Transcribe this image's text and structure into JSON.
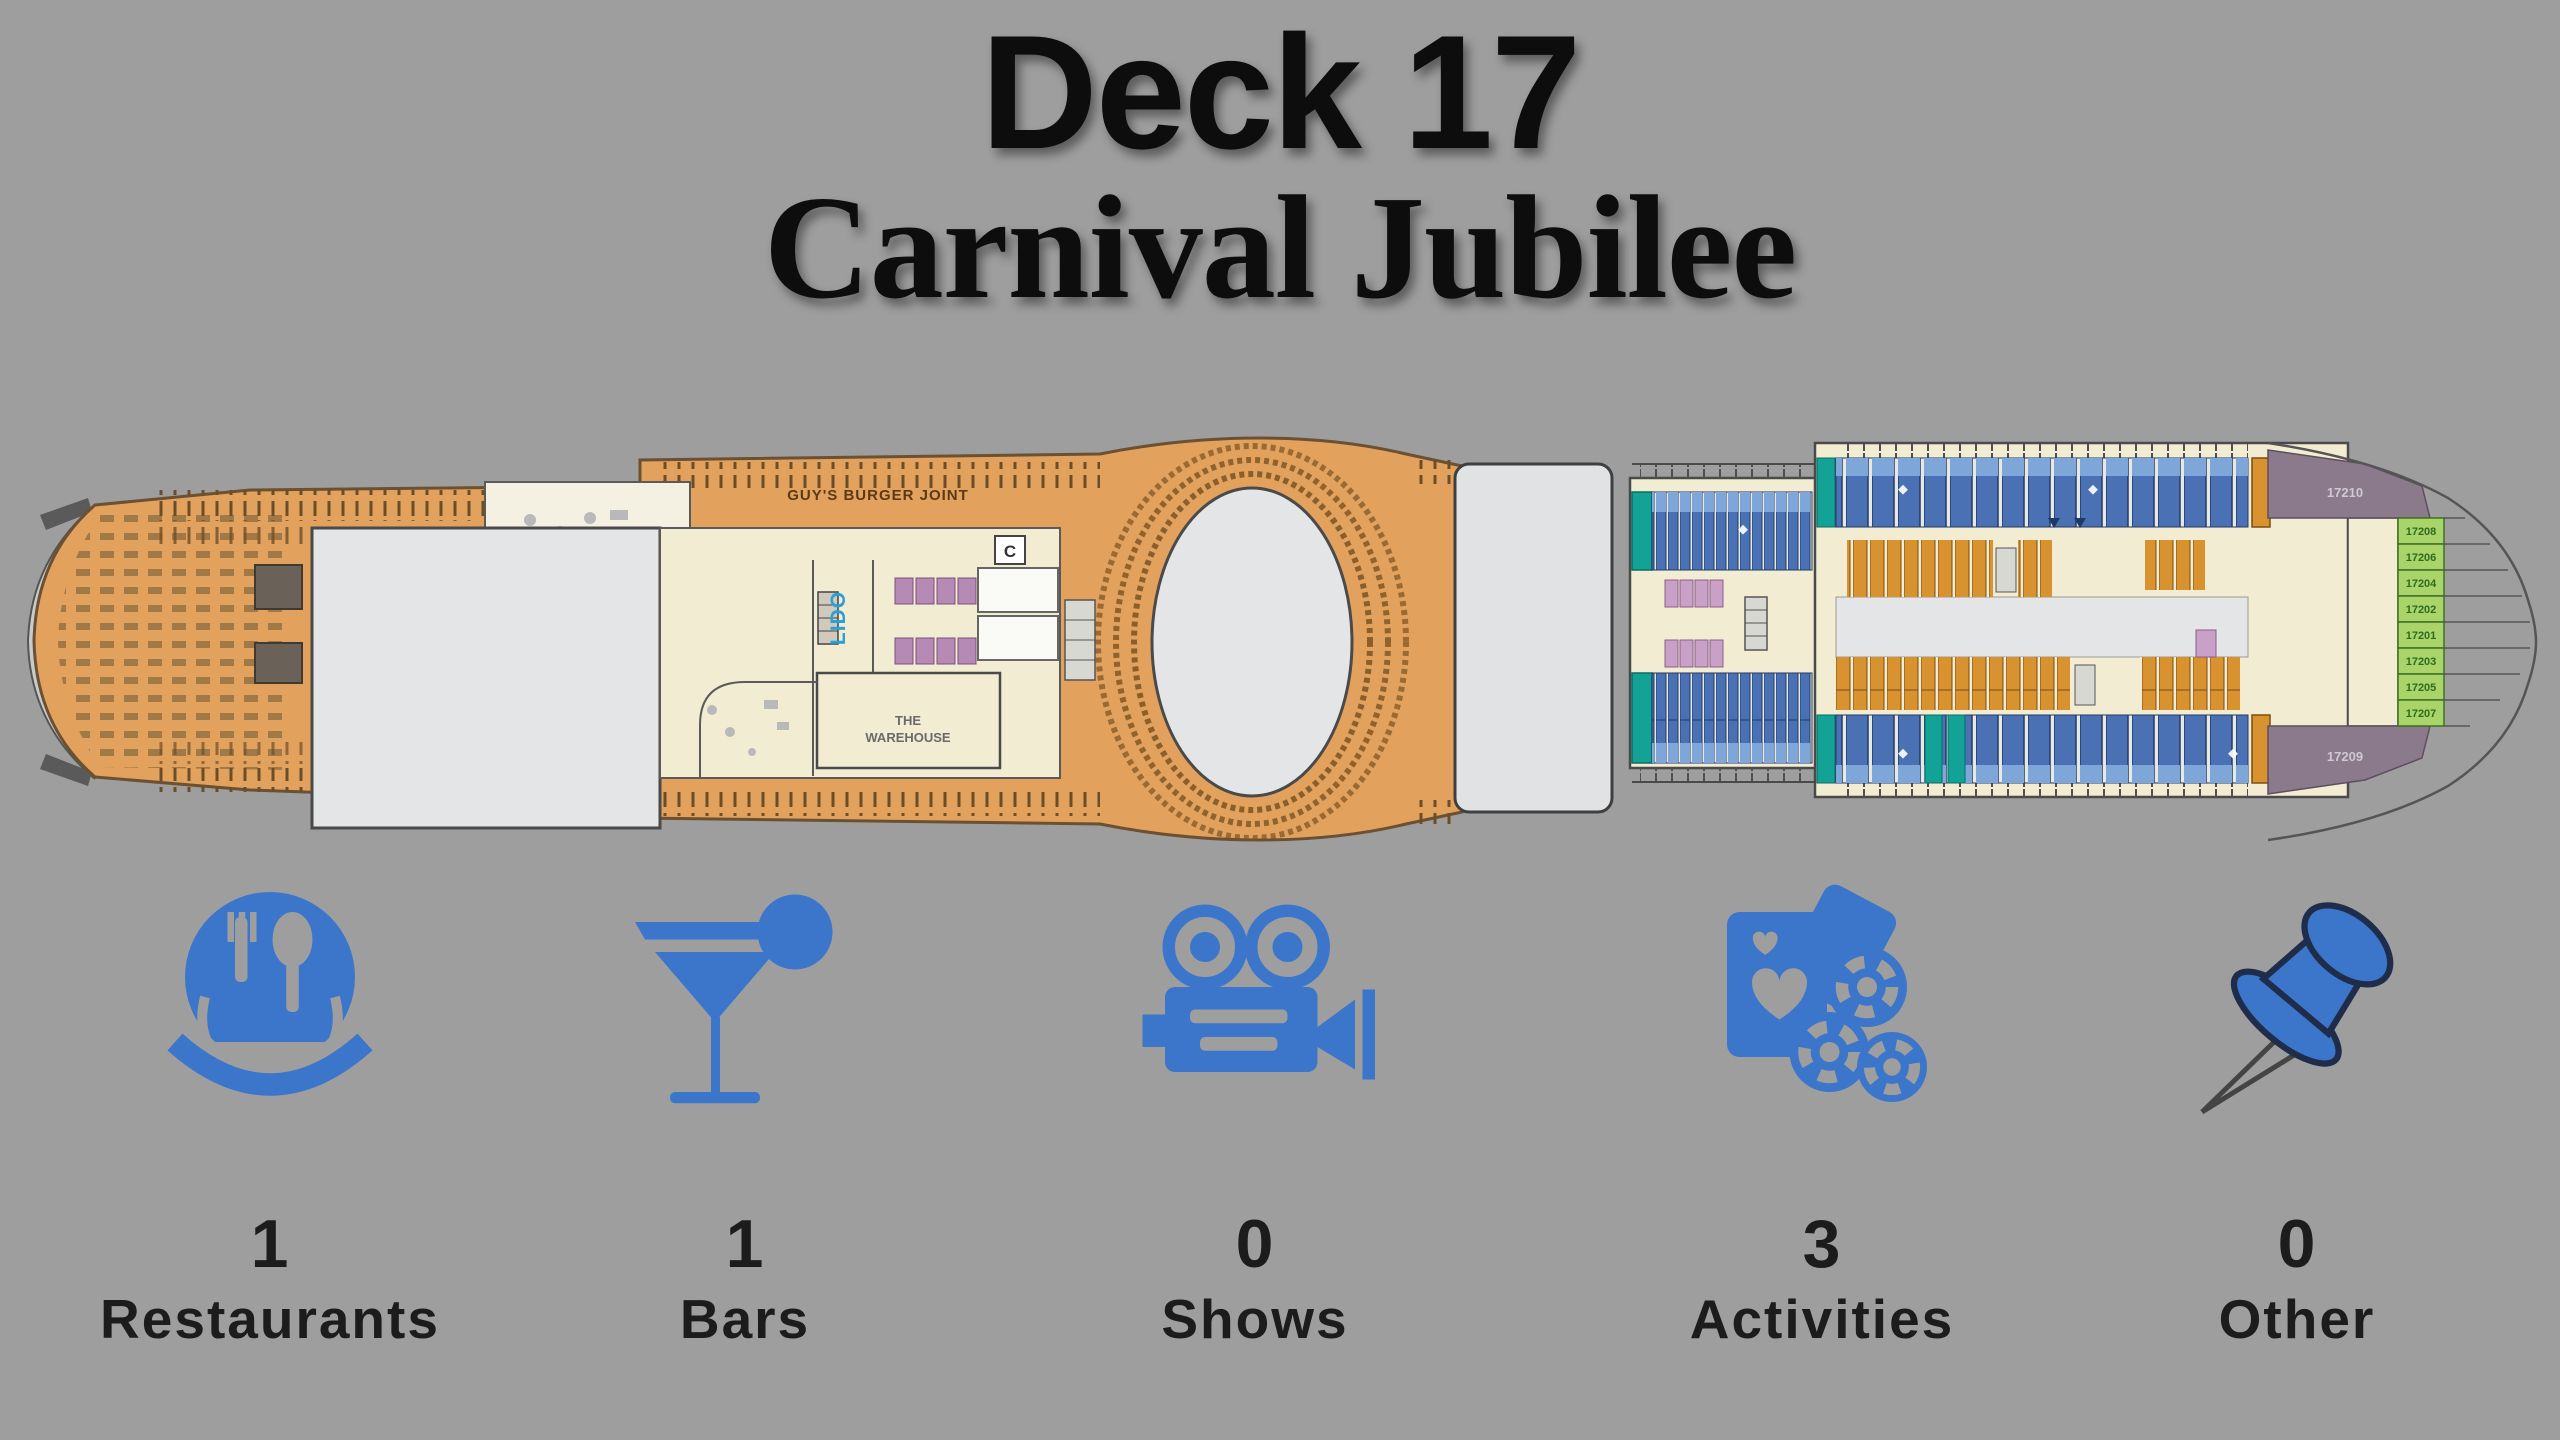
{
  "header": {
    "deck_title": "Deck 17",
    "ship_name": "Carnival Jubilee"
  },
  "deck_plan": {
    "venues": {
      "burger_joint": "GUY'S BURGER JOINT",
      "lido": "LIDO",
      "warehouse_line1": "THE",
      "warehouse_line2": "WAREHOUSE",
      "elevator": "C"
    },
    "cabin_numbers": {
      "bow_top_corner": "17210",
      "bow_bottom_corner": "17209",
      "green": [
        "17208",
        "17206",
        "17204",
        "17202",
        "17201",
        "17203",
        "17205",
        "17207"
      ]
    }
  },
  "stats": [
    {
      "id": "restaurants",
      "icon": "restaurant-icon",
      "count": "1",
      "label": "Restaurants"
    },
    {
      "id": "bars",
      "icon": "cocktail-icon",
      "count": "1",
      "label": "Bars"
    },
    {
      "id": "shows",
      "icon": "movie-camera-icon",
      "count": "0",
      "label": "Shows"
    },
    {
      "id": "activities",
      "icon": "casino-icon",
      "count": "3",
      "label": "Activities"
    },
    {
      "id": "other",
      "icon": "push-pin-icon",
      "count": "0",
      "label": "Other"
    }
  ],
  "colors": {
    "background": "#9e9e9e",
    "icon_blue": "#3b76cb",
    "deck_orange": "#e2a25e",
    "cabin_blue": "#4a71b4",
    "cabin_blue_light": "#7ea6d8",
    "cabin_teal": "#12a296",
    "cabin_orange": "#d8922f",
    "cabin_green": "#a8d46a",
    "cabin_pink": "#c9a0c8",
    "corner_purple": "#8b7a8c",
    "room_cream": "#f2ecd2",
    "open_gray": "#e3e5e6"
  }
}
